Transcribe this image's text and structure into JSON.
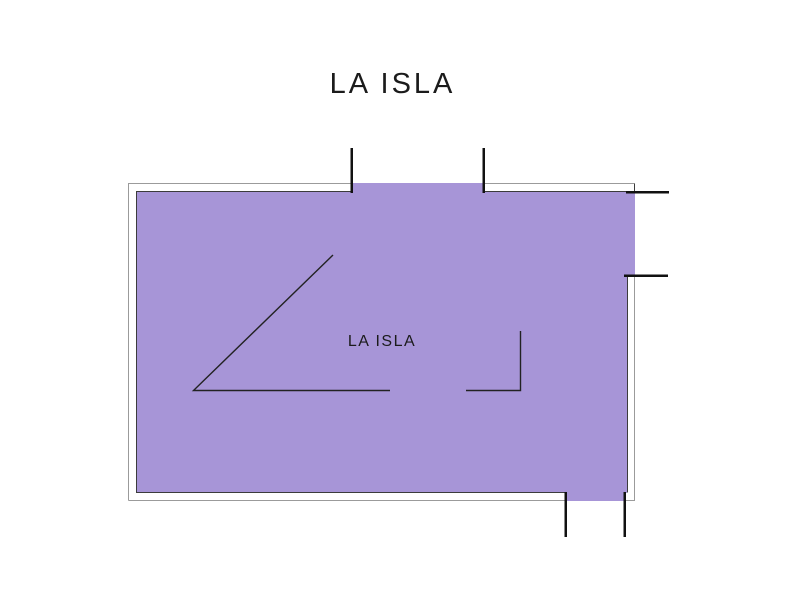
{
  "page": {
    "title": "LA ISLA",
    "background_color": "#ffffff",
    "text_color": "#1b1b1b"
  },
  "floor_plan": {
    "room_label": "LA ISLA",
    "colors": {
      "room_fill": "#a795d7",
      "wall_outer": "#9b9b9b",
      "wall_inner": "#3c3c3c",
      "opening_tick": "#111111",
      "annotation_line": "#222222"
    }
  }
}
